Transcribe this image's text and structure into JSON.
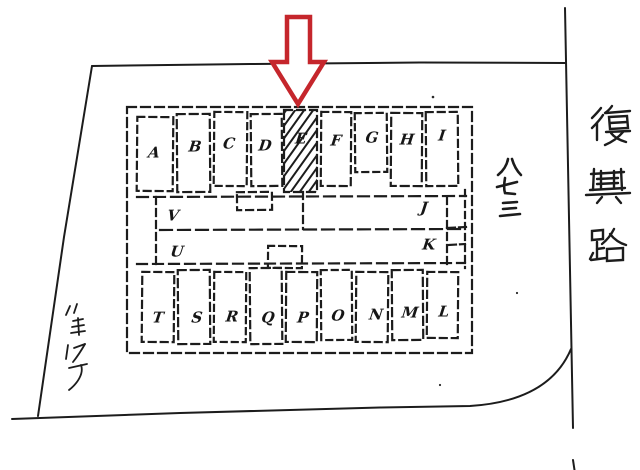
{
  "canvas": {
    "width": 640,
    "height": 470,
    "background": "#ffffff",
    "ink_color": "#1c1c1c",
    "arrow_color": "#c5262c"
  },
  "map": {
    "road_name": "復興路",
    "road_name_chars": [
      "復",
      "興",
      "路"
    ],
    "address_number": "八七三",
    "address_number_chars": [
      "八",
      "七",
      "三"
    ],
    "handwritten_note": "八三17子",
    "highlighted_plot": "E",
    "plots": {
      "top_row": [
        "A",
        "B",
        "C",
        "D",
        "E",
        "F",
        "G",
        "H",
        "I"
      ],
      "middle_left": [
        "V",
        "U"
      ],
      "middle_right": [
        "J",
        "K"
      ],
      "bottom_row": [
        "T",
        "S",
        "R",
        "Q",
        "P",
        "O",
        "N",
        "M",
        "L"
      ]
    }
  }
}
